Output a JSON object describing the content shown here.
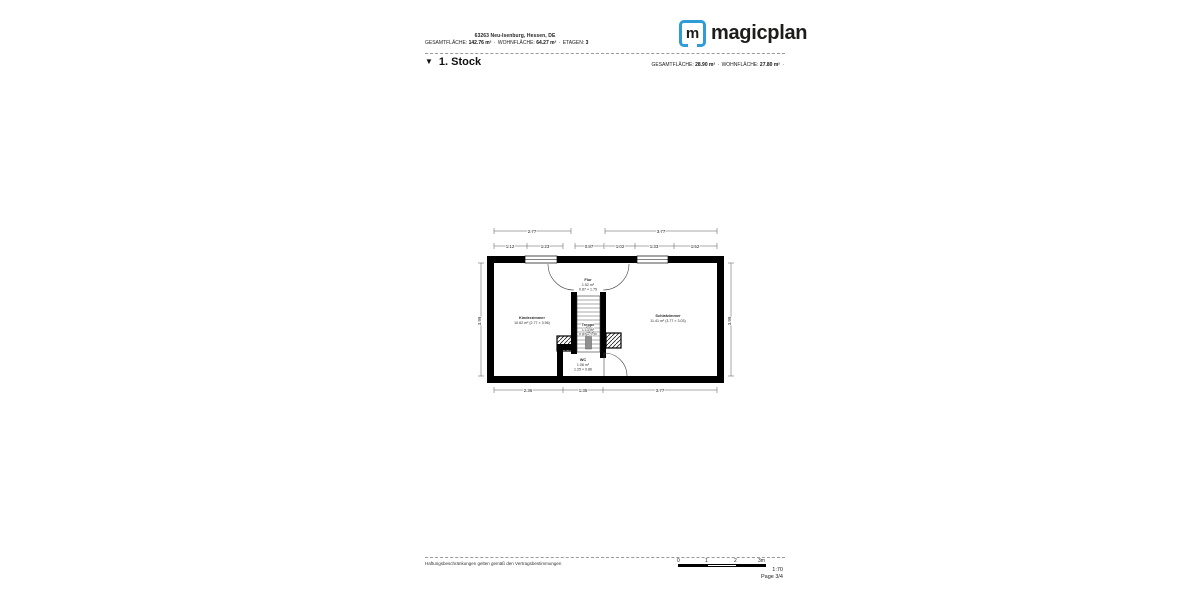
{
  "header": {
    "address": "63263 Neu-Isenburg, Hessen, DE",
    "sep": "·",
    "stats": [
      {
        "label": "GESAMTFLÄCHE:",
        "value": "142.76 m²"
      },
      {
        "label": "WOHNFLÄCHE:",
        "value": "64.27 m²"
      },
      {
        "label": "ETAGEN:",
        "value": "3"
      }
    ],
    "logo": {
      "letter": "m",
      "name": "magicplan"
    }
  },
  "floor": {
    "marker": "▼",
    "title": "1. Stock",
    "sep": "·",
    "stats": [
      {
        "label": "GESAMTFLÄCHE:",
        "value": "28.90 m²"
      },
      {
        "label": "WOHNFLÄCHE:",
        "value": "27.80 m²"
      }
    ],
    "trailing": "·"
  },
  "plan": {
    "rooms": {
      "kinderzimmer": {
        "name": "Kinderzimmer",
        "area": "10.62 m² (2.77 × 3.96)"
      },
      "schlafzimmer": {
        "name": "Schlafzimmer",
        "area": "11.41 m² (3.77 × 3.03)"
      },
      "flur": {
        "name": "Flur",
        "area": "1.52 m²",
        "dims": "0.87 × 1.75"
      },
      "treppe": {
        "name": "Treppe",
        "area": "1.13 m²",
        "dims": "0.87 × 1.30"
      },
      "wc": {
        "name": "WC",
        "area": "1.08 m²",
        "dims": "1.25 × 0.86"
      }
    },
    "dims": {
      "top1": [
        "2.77",
        "3.77"
      ],
      "top2": [
        "1.12",
        "1.23",
        "0.87",
        "1.02",
        "1.33",
        "1.52"
      ],
      "bottom": [
        "2.36",
        "1.35",
        "3.77"
      ],
      "left": "3.99",
      "right": "3.99"
    }
  },
  "footer": {
    "disclaimer": "Haftungsbeschränkungen gelten gemäß den Vertragsbestimmungen",
    "scale_ticks": [
      "0",
      "1",
      "2",
      "3m"
    ],
    "ratio": "1:70",
    "page": "Page 3/4"
  },
  "colors": {
    "brand_blue": "#2e9cd6",
    "wall": "#000000"
  }
}
